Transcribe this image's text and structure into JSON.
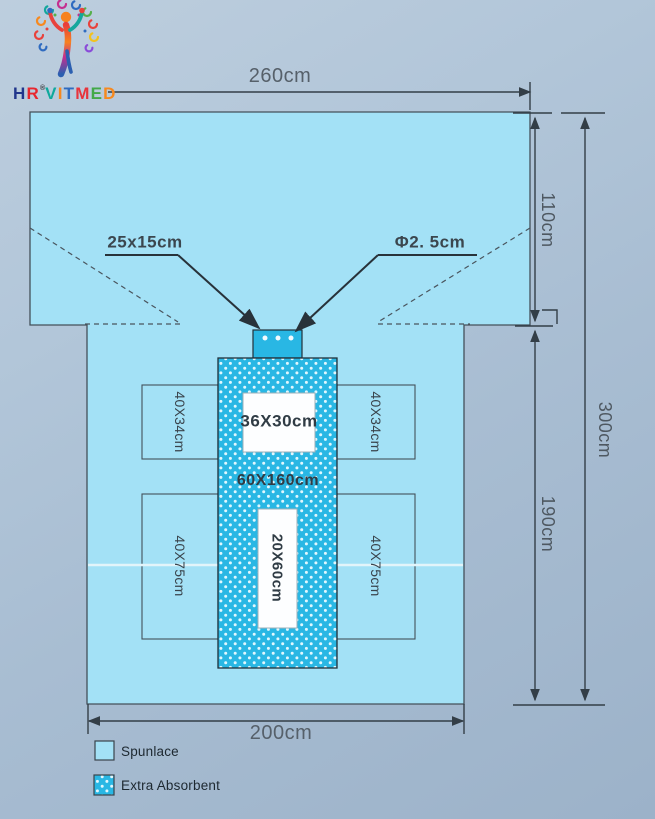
{
  "logo": {
    "brand_letters": [
      {
        "ch": "H",
        "color": "#21368c"
      },
      {
        "ch": "R",
        "color": "#e8272e"
      },
      {
        "ch": "®",
        "color": "#3a3a3a",
        "sup": true
      },
      {
        "ch": "V",
        "color": "#0fa99c"
      },
      {
        "ch": "I",
        "color": "#f6891f"
      },
      {
        "ch": "T",
        "color": "#2f6bc0"
      },
      {
        "ch": "M",
        "color": "#e8343c"
      },
      {
        "ch": "E",
        "color": "#42a948"
      },
      {
        "ch": "D",
        "color": "#f6891f"
      }
    ]
  },
  "diagram": {
    "dimensions": {
      "top_width": "260cm",
      "right_upper": "110cm",
      "right_total": "300cm",
      "right_lower": "190cm",
      "bottom_width": "200cm"
    },
    "callouts": {
      "adhesive_tab": "25x15cm",
      "hole_diameter": "Φ2. 5cm"
    },
    "zones": {
      "fenestration_top": "36X30cm",
      "absorbent_zone": "60X160cm",
      "fenestration_bottom": "20X60cm",
      "side_pad_upper": "40X34cm",
      "side_pad_lower": "40X75cm"
    }
  },
  "legend": {
    "spunlace_label": "Spunlace",
    "absorbent_label": "Extra Absorbent"
  },
  "colors": {
    "spunlace": "#a3e1f6",
    "absorbent": "#29b7e4",
    "line": "#333e47",
    "dim_text": "#56606a"
  }
}
